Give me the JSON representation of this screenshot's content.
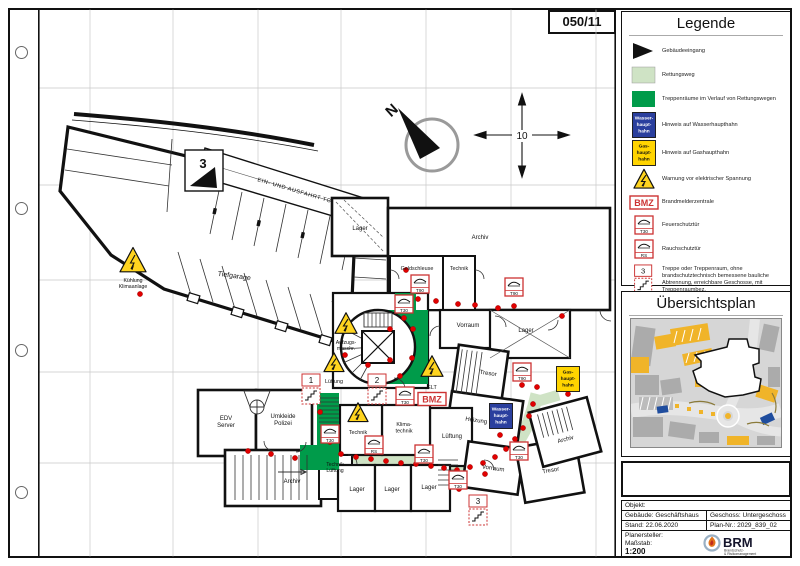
{
  "page": {
    "sheet_number": "050/11"
  },
  "colors": {
    "escape_route": "#cfe3c5",
    "stairwell_green": "#009b4a",
    "water_sign_blue": "#2a3f9e",
    "gas_sign_yellow": "#ffd400",
    "warning_yellow": "#ffd41f",
    "symbol_red": "#cc3333",
    "dot_red": "#e00000",
    "banner_red": "#9b222b"
  },
  "legend": {
    "title": "Legende",
    "items": [
      {
        "icon": "building-entrance",
        "label": "Gebäudeeingang"
      },
      {
        "icon": "escape-route",
        "label": "Rettungsweg"
      },
      {
        "icon": "stairwell",
        "label": "Treppenräume im Verlauf von Rettungswegen"
      },
      {
        "icon": "water-main",
        "label": "Hinweis auf Wasserhaupthahn"
      },
      {
        "icon": "gas-main",
        "label": "Hinweis auf Gashaupthahn"
      },
      {
        "icon": "electric-warning",
        "label": "Warnung vor elektrischer Spannung"
      },
      {
        "icon": "bmz-panel",
        "label": "Brandmelderzentrale"
      },
      {
        "icon": "fire-door",
        "label": "Feuerschutztür"
      },
      {
        "icon": "smoke-door",
        "label": "Rauchschutztür"
      },
      {
        "icon": "stair-room",
        "label": "Treppe oder Treppenraum, ohne brandschutztechnisch bemessene bauliche Abtrennung, erreichbare Geschosse, mit Treppenraumbez."
      }
    ]
  },
  "overview": {
    "title": "Übersichtsplan"
  },
  "titleblock": {
    "title": "Feuerwehrplan",
    "objekt": "Objekt:",
    "gebaeude": "Gebäude:  Geschäftshaus",
    "geschoss": "Geschoss:  Untergeschoss",
    "stand": "Stand:      22.06.2020",
    "plan_nr": "Plan-Nr.:   2029_839_02",
    "planersteller": "Planersteller:",
    "massstab_label": "Maßstab:",
    "massstab": "1:200",
    "logo": {
      "name": "BRM",
      "sub1": "Brandschutz-",
      "sub2": "& Risikomanagement"
    }
  },
  "plan": {
    "labels": [
      {
        "t": "Tiefgarage",
        "x": 196,
        "y": 270,
        "fs": 7,
        "rot": 8
      },
      {
        "t": "EIN- UND AUSFAHRT TG",
        "x": 256,
        "y": 184,
        "fs": 5.6,
        "rot": 16.5,
        "ls": 0.6
      },
      {
        "t": "3",
        "x": 165,
        "y": 160,
        "fs": 13,
        "bold": true
      },
      {
        "t": [
          "Kühlung",
          "Klimaanlage"
        ],
        "x": 95,
        "y": 274,
        "fs": 5.2
      },
      {
        "t": "Lager",
        "x": 322,
        "y": 222,
        "fs": 6
      },
      {
        "t": "Archiv",
        "x": 442,
        "y": 231,
        "fs": 6
      },
      {
        "t": "Geldschleuse",
        "x": 379,
        "y": 262,
        "fs": 5.4
      },
      {
        "t": "Technik",
        "x": 421,
        "y": 262,
        "fs": 5.4
      },
      {
        "t": "Vorraum",
        "x": 430,
        "y": 319,
        "fs": 6
      },
      {
        "t": "Lager",
        "x": 488,
        "y": 324,
        "fs": 6
      },
      {
        "t": "Tresor",
        "x": 450,
        "y": 367,
        "fs": 6,
        "rot": 8
      },
      {
        "t": [
          "Aufzugs-",
          "maschr."
        ],
        "x": 308,
        "y": 336,
        "fs": 5.2
      },
      {
        "t": "Lüftung",
        "x": 296,
        "y": 375,
        "fs": 5.4
      },
      {
        "t": "ELT",
        "x": 394,
        "y": 381,
        "fs": 5.4
      },
      {
        "t": [
          "EDV",
          "Server"
        ],
        "x": 188,
        "y": 412,
        "fs": 6
      },
      {
        "t": [
          "Umkleide",
          "Polizei"
        ],
        "x": 245,
        "y": 410,
        "fs": 6
      },
      {
        "t": "Technik",
        "x": 320,
        "y": 426,
        "fs": 5.4
      },
      {
        "t": [
          "Klima-",
          "technik"
        ],
        "x": 366,
        "y": 418,
        "fs": 5.4
      },
      {
        "t": "Lüftung",
        "x": 414,
        "y": 430,
        "fs": 6
      },
      {
        "t": "Heizung",
        "x": 438,
        "y": 414,
        "fs": 6,
        "rot": 8
      },
      {
        "t": "Archiv",
        "x": 528,
        "y": 433,
        "fs": 6,
        "rot": -15
      },
      {
        "t": "Archiv",
        "x": 254,
        "y": 475,
        "fs": 6
      },
      {
        "t": [
          "Technik",
          "Lüftung"
        ],
        "x": 297,
        "y": 458,
        "fs": 5.2
      },
      {
        "t": "Lager",
        "x": 319,
        "y": 483,
        "fs": 6
      },
      {
        "t": "Lager",
        "x": 354,
        "y": 483,
        "fs": 6
      },
      {
        "t": "Lager",
        "x": 391,
        "y": 481,
        "fs": 6
      },
      {
        "t": "Vorraum",
        "x": 455,
        "y": 462,
        "fs": 6,
        "rot": 8
      },
      {
        "t": "Tresor",
        "x": 513,
        "y": 464,
        "fs": 6,
        "rot": -10
      },
      {
        "t": "N",
        "x": 357,
        "y": 106,
        "fs": 15,
        "rot": -42,
        "bold": true
      },
      {
        "t": "10",
        "x": 484,
        "y": 131,
        "fs": 10,
        "bg": true
      }
    ],
    "doors": [
      {
        "l": "T90",
        "x": 382,
        "y": 276
      },
      {
        "l": "T90",
        "x": 476,
        "y": 279
      },
      {
        "l": "T30",
        "x": 366,
        "y": 296
      },
      {
        "l": "T90",
        "x": 484,
        "y": 364
      },
      {
        "l": "T30",
        "x": 367,
        "y": 388
      },
      {
        "l": "T30",
        "x": 292,
        "y": 426
      },
      {
        "l": "RS",
        "x": 336,
        "y": 437
      },
      {
        "l": "T30",
        "x": 386,
        "y": 446
      },
      {
        "l": "T30",
        "x": 481,
        "y": 443
      },
      {
        "l": "T30",
        "x": 420,
        "y": 472
      }
    ],
    "warnings": [
      {
        "x": 95,
        "y": 254,
        "s": 26
      },
      {
        "x": 308,
        "y": 317,
        "s": 22
      },
      {
        "x": 296,
        "y": 356,
        "s": 20
      },
      {
        "x": 394,
        "y": 360,
        "s": 22
      },
      {
        "x": 320,
        "y": 406,
        "s": 20
      }
    ],
    "stair_markers": [
      {
        "n": "1",
        "x": 273,
        "y": 366
      },
      {
        "n": "2",
        "x": 339,
        "y": 366
      },
      {
        "n": "3",
        "x": 440,
        "y": 487
      }
    ],
    "signs": [
      {
        "type": "water",
        "x": 463,
        "y": 408,
        "lines": [
          "Wasser-",
          "haupt-",
          "hahn"
        ]
      },
      {
        "type": "gas",
        "x": 530,
        "y": 371,
        "lines": [
          "Gas-",
          "haupt-",
          "hahn"
        ]
      }
    ],
    "bmz": {
      "text": "BMZ",
      "x": 394,
      "y": 391
    },
    "dots": [
      [
        102,
        286
      ],
      [
        368,
        262
      ],
      [
        380,
        291
      ],
      [
        398,
        293
      ],
      [
        366,
        310
      ],
      [
        352,
        321
      ],
      [
        375,
        321
      ],
      [
        352,
        352
      ],
      [
        374,
        350
      ],
      [
        330,
        357
      ],
      [
        307,
        347
      ],
      [
        362,
        368
      ],
      [
        394,
        354
      ],
      [
        420,
        296
      ],
      [
        437,
        297
      ],
      [
        460,
        300
      ],
      [
        476,
        298
      ],
      [
        524,
        308
      ],
      [
        484,
        377
      ],
      [
        499,
        379
      ],
      [
        530,
        386
      ],
      [
        282,
        404
      ],
      [
        286,
        420
      ],
      [
        292,
        434
      ],
      [
        303,
        446
      ],
      [
        318,
        449
      ],
      [
        333,
        451
      ],
      [
        348,
        453
      ],
      [
        363,
        455
      ],
      [
        378,
        456
      ],
      [
        393,
        458
      ],
      [
        406,
        460
      ],
      [
        419,
        462
      ],
      [
        432,
        459
      ],
      [
        445,
        455
      ],
      [
        457,
        449
      ],
      [
        468,
        441
      ],
      [
        477,
        431
      ],
      [
        485,
        420
      ],
      [
        491,
        408
      ],
      [
        495,
        396
      ],
      [
        462,
        427
      ],
      [
        447,
        466
      ],
      [
        421,
        481
      ],
      [
        210,
        443
      ],
      [
        233,
        446
      ],
      [
        257,
        450
      ]
    ]
  }
}
